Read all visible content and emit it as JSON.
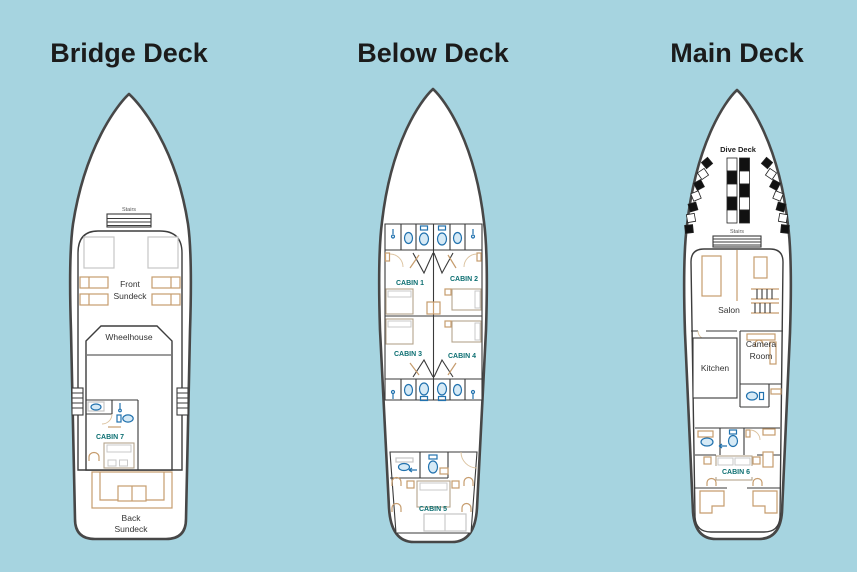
{
  "figure": "boat-deck-plans",
  "colors": {
    "background": "#a6d4e0",
    "hull_outline": "#474747",
    "hull_fill": "#ffffff",
    "interior_wall": "#3a3a3a",
    "furniture_tan": "#c69c6d",
    "fixture_blue": "#2272ae",
    "cabin_label_teal": "#0d6f72",
    "title_text": "#1b1b1b"
  },
  "decks": [
    {
      "id": "bridge-deck",
      "title": "Bridge Deck",
      "labels": {
        "stairs": "Stairs",
        "front_line1": "Front",
        "front_line2": "Sundeck",
        "wheelhouse": "Wheelhouse",
        "cabin": "CABIN 7",
        "back_line1": "Back",
        "back_line2": "Sundeck"
      }
    },
    {
      "id": "below-deck",
      "title": "Below Deck",
      "labels": {
        "cabin1": "CABIN 1",
        "cabin2": "CABIN 2",
        "cabin3": "CABIN 3",
        "cabin4": "CABIN 4",
        "cabin5": "CABIN 5"
      }
    },
    {
      "id": "main-deck",
      "title": "Main Deck",
      "labels": {
        "dive_deck": "Dive Deck",
        "stairs": "Stairs",
        "salon": "Salon",
        "kitchen": "Kitchen",
        "camera_line1": "Camera",
        "camera_line2": "Room",
        "cabin": "CABIN 6"
      }
    }
  ]
}
